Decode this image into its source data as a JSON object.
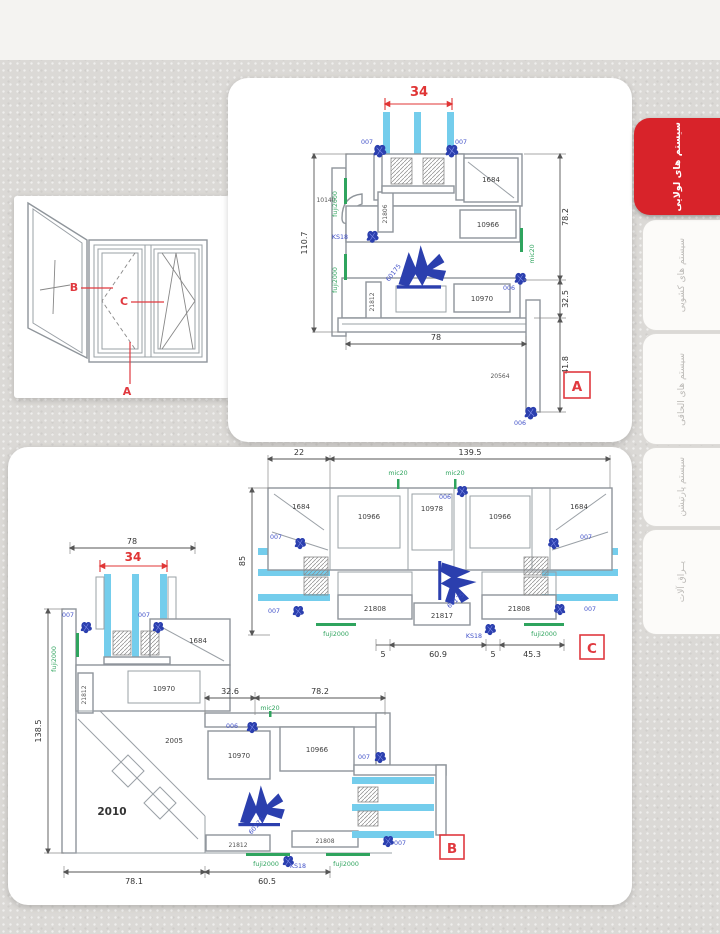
{
  "colors": {
    "accent_red": "#d8232a",
    "dimension_red": "#e03535",
    "part_label_blue": "#4050c8",
    "hardware_blue": "#2b3fae",
    "gasket_green": "#2fa45e",
    "glass_blue": "#74cdec"
  },
  "tabs": [
    {
      "label": "سیستم های لولایی",
      "active": true
    },
    {
      "label": "سیستم های کشویی",
      "active": false
    },
    {
      "label": "سیستم های الحاقی",
      "active": false
    },
    {
      "label": "سیستم پارتیشن",
      "active": false
    },
    {
      "label": "یــراق آلات",
      "active": false
    }
  ],
  "elevation": {
    "marker_a": "A",
    "marker_b": "B",
    "marker_c": "C"
  },
  "section_a": {
    "badge": "A",
    "dim_glass": "34",
    "dim_height": "110.7",
    "dim_right_height": "78.2",
    "dim_step": "32.5",
    "dim_width": "78",
    "dim_tail": "41.8",
    "p007_left": "007",
    "p007_right": "007",
    "p1684": "1684",
    "p10140": "10140",
    "p21806": "21806",
    "ks18": "KS18",
    "fuji_upper": "fuji2000",
    "fuji_lower": "fuji2000",
    "p60175": "60175",
    "p10966": "10966",
    "mic20": "mic20",
    "p006_right": "006",
    "p21812": "21812",
    "p10970": "10970",
    "p20564": "20564",
    "p006_bottom": "006"
  },
  "section_c": {
    "badge": "C",
    "dim_left": "22",
    "dim_total": "139.5",
    "dim_height": "85",
    "dim_s1": "5",
    "dim_mid": "60.9",
    "dim_s2": "5",
    "dim_right": "45.3",
    "mic20_left": "mic20",
    "mic20_right": "mic20",
    "p006": "006",
    "p1684_left": "1684",
    "p1684_right": "1684",
    "p10966_left": "10966",
    "p10966_right": "10966",
    "p10978": "10978",
    "p007_tl": "007",
    "p007_tr": "007",
    "p007_bl": "007",
    "p007_br": "007",
    "p21808_left": "21808",
    "p21817": "21817",
    "p21808_right": "21808",
    "fuji_left": "fuji2000",
    "fuji_right": "fuji2000",
    "ks18": "KS18",
    "p60175": "60175"
  },
  "section_b": {
    "badge": "B",
    "dim_top": "78",
    "dim_glass": "34",
    "dim_height": "138.5",
    "dim_a": "32.6",
    "dim_b": "78.2",
    "dim_w1": "78.1",
    "dim_w2": "60.5",
    "p007_tl": "007",
    "p007_tr": "007",
    "p1684": "1684",
    "fuji_left": "fuji2000",
    "p21812_vert": "21812",
    "p10970_top": "10970",
    "mic20": "mic20",
    "p006": "006",
    "p10970": "10970",
    "p10966": "10966",
    "p2005": "2005",
    "p2010": "2010",
    "p21812": "21812",
    "p21808": "21808",
    "p007_r1": "007",
    "p007_r2": "007",
    "p60175": "60175",
    "ks18": "KS18",
    "fuji_b1": "fuji2000",
    "fuji_b2": "fuji2000"
  }
}
